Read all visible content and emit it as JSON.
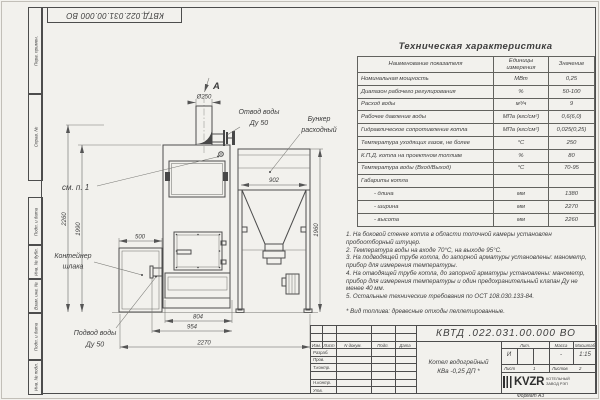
{
  "colors": {
    "paper": "#f2f1ed",
    "ink": "#3e3e3e",
    "line": "#4d4d4d"
  },
  "sheet": {
    "designation_top": "КВТД.022.031.00.000 ВО",
    "format_note": "Формат А3"
  },
  "margin_labels": [
    "Перв. примен.",
    "Справ. №",
    "Подп. и дата",
    "Инв. № дубл.",
    "Взам. инв. №",
    "Подп. и дата",
    "Инв. № подл."
  ],
  "drawing": {
    "view_label": "А",
    "dims": {
      "dia": "Ø250",
      "w902": "902",
      "w500": "500",
      "h2260": "2260",
      "h1990": "1990",
      "h1960": "1960",
      "w804": "804",
      "w954": "954",
      "w2270": "2270"
    },
    "labels": {
      "outlet1": "Отвод воды",
      "outlet2": "Ду 50",
      "hopper1": "Бункер",
      "hopper2": "расходный",
      "see_note": "см. п. 1",
      "slag1": "Контейнер",
      "slag2": "шлака",
      "inlet1": "Подвод воды",
      "inlet2": "Ду 50"
    }
  },
  "spec": {
    "title": "Техническая характеристика",
    "headers": [
      "Наименование показателя",
      "Единицы измерения",
      "Значение"
    ],
    "rows": [
      {
        "name": "Номинальная мощность",
        "unit": "МВт",
        "value": "0,25"
      },
      {
        "name": "Диапазон рабочего регулирования",
        "unit": "%",
        "value": "50-100"
      },
      {
        "name": "Расход воды",
        "unit": "м³/ч",
        "value": "9"
      },
      {
        "name": "Рабочее давление воды",
        "unit": "МПа (кгс/см²)",
        "value": "0,6(6,0)"
      },
      {
        "name": "Гидравлическое сопротивление котла",
        "unit": "МПа (кгс/см²)",
        "value": "0,025(0,25)"
      },
      {
        "name": "Температура уходящих газов, не более",
        "unit": "°С",
        "value": "250"
      },
      {
        "name": "К.П.Д. котла на проектном топливе",
        "unit": "%",
        "value": "80"
      },
      {
        "name": "Температура воды (Вход/Выход)",
        "unit": "°С",
        "value": "70-95"
      },
      {
        "name": "Габариты котла",
        "unit": "",
        "value": ""
      },
      {
        "name": "- длина",
        "unit": "мм",
        "value": "1380"
      },
      {
        "name": "- ширина",
        "unit": "мм",
        "value": "2270"
      },
      {
        "name": "- высота",
        "unit": "мм",
        "value": "2260"
      }
    ]
  },
  "notes": [
    "1. На боковой стенке котла в области топочной камеры установлен пробоотборный штуцер.",
    "2. Температура воды на входе 70°С, на выходе 95°С.",
    "3. На подводящей трубе котла, до запорной арматуры установлены: манометр, прибор для измерения температуры.",
    "4. На отводящей трубе котла, до запорной арматуры установлены: манометр, прибор для измерения температуры и один предохранительный клапан Ду не менее 40 мм.",
    "5. Остальные технические требования по ОСТ 108.030.133-84.",
    "* Вид топлива: древесные отходы пеллетированные."
  ],
  "title_block": {
    "designation": "КВТД .022.031.00.000 ВО",
    "name1": "Котел водогрейный",
    "name2": "КВа -0,25 ДП *",
    "cols": [
      "Изм.",
      "Лист",
      "N докум.",
      "Подп.",
      "Дата"
    ],
    "roles": [
      "Разраб.",
      "Пров.",
      "Т.контр.",
      "Н.контр.",
      "Утв."
    ],
    "lit_label": "Лит.",
    "lit": "И",
    "mass_label": "Масса",
    "mass": "-",
    "scale_label": "Масштаб",
    "scale": "1:15",
    "sheet_label": "Лист",
    "sheet": "1",
    "sheets_label": "Листов",
    "sheets": "2",
    "logo": "KVZR",
    "logo_cap1": "КОТЕЛЬНЫЙ",
    "logo_cap2": "ЗАВОД РЭП"
  }
}
